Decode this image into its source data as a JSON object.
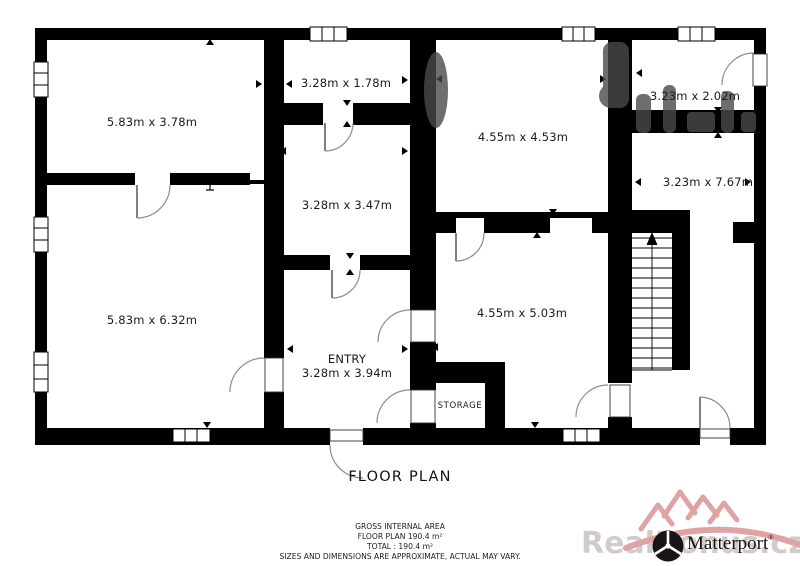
{
  "plan": {
    "title": "FLOOR PLAN",
    "rooms": {
      "top_left": "5.83m x 3.78m",
      "top_middle": "3.28m x 1.78m",
      "center": "4.55m x 4.53m",
      "top_right": "3.23m x 2.02m",
      "right_hall": "3.23m x 7.67m",
      "middle": "3.28m x 3.47m",
      "bottom_left": "5.83m x 6.32m",
      "bottom_center": "4.55m x 5.03m",
      "entry_name": "ENTRY",
      "entry_dims": "3.28m x 3.94m",
      "storage": "STORAGE"
    }
  },
  "footer": {
    "line1": "GROSS INTERNAL AREA",
    "line2": "FLOOR PLAN 190.4 m²",
    "line3": "TOTAL :  190.4 m²",
    "line4": "SIZES AND DIMENSIONS ARE APPROXIMATE, ACTUAL MAY VARY."
  },
  "branding": {
    "matterport": "Matterport",
    "registered_mark": "®",
    "watermark": "RealBonus.cz"
  },
  "colors": {
    "wall": "#000000",
    "door_arc": "#8c8c8c",
    "watermark_gray": "#4a4a4a",
    "brand_pink": "#dfa3a3",
    "watermark_text": "#d3caca"
  }
}
